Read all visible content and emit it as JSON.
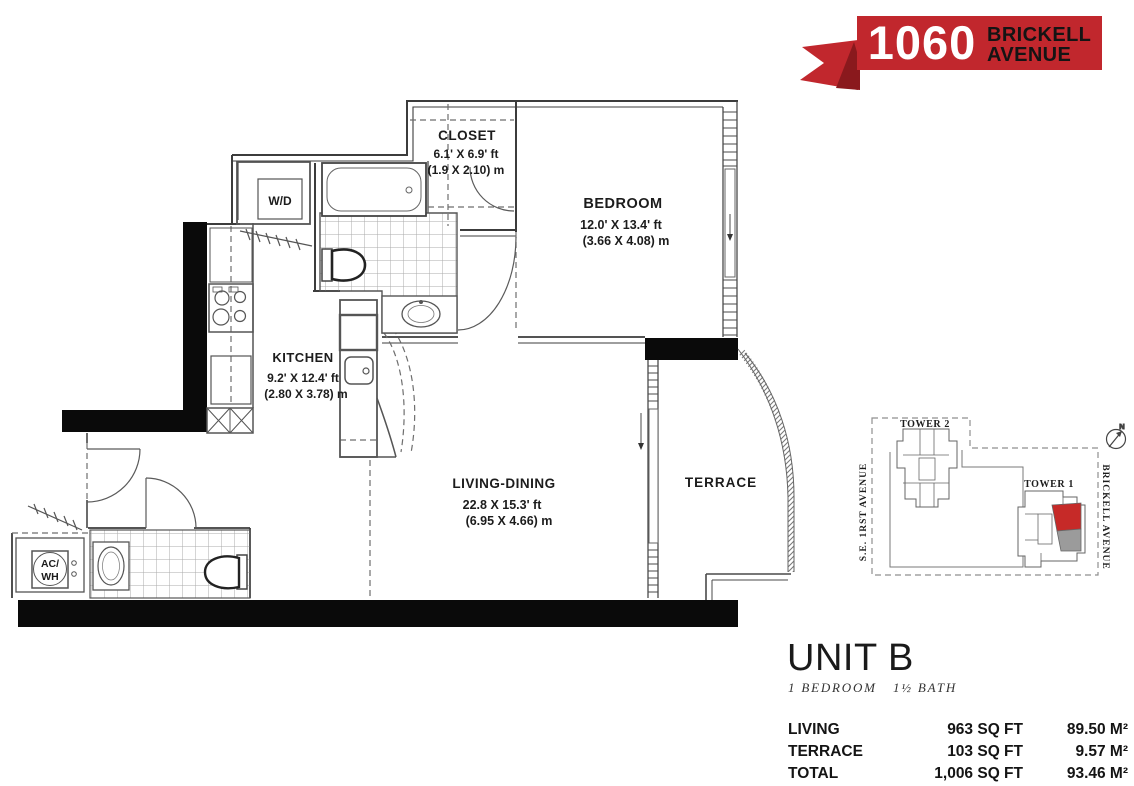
{
  "logo": {
    "number": "1060",
    "line1": "BRICKELL",
    "line2": "AVENUE",
    "red": "#c1272d",
    "dark_red": "#8a191d"
  },
  "rooms": {
    "closet": {
      "name": "CLOSET",
      "dim_ft": "6.1' X 6.9' ft",
      "dim_m": "(1.9 X 2.10) m"
    },
    "bedroom": {
      "name": "BEDROOM",
      "dim_ft": "12.0' X 13.4' ft",
      "dim_m": "(3.66 X 4.08) m"
    },
    "kitchen": {
      "name": "KITCHEN",
      "dim_ft": "9.2' X 12.4' ft",
      "dim_m": "(2.80 X 3.78) m"
    },
    "living": {
      "name": "LIVING-DINING",
      "dim_ft": "22.8 X 15.3' ft",
      "dim_m": "(6.95 X 4.66) m"
    },
    "terrace": {
      "name": "TERRACE"
    },
    "washer_dryer": {
      "name": "W/D"
    },
    "ac_water_heater": {
      "line1": "AC/",
      "line2": "WH"
    }
  },
  "sitemap": {
    "tower1": "TOWER 1",
    "tower2": "TOWER 2",
    "street_left": "S.E. 1RST AVENUE",
    "street_right": "BRICKELL AVENUE",
    "compass": "N",
    "highlight_red": "#c62a28",
    "highlight_gray": "#9b9b9b"
  },
  "unit": {
    "title": "UNIT B",
    "subtitle_bed": "1  BEDROOM",
    "subtitle_bath": "1½  BATH",
    "stats": [
      {
        "label": "LIVING",
        "sqft": "963 SQ FT",
        "m2": "89.50 M²"
      },
      {
        "label": "TERRACE",
        "sqft": "103 SQ FT",
        "m2": "9.57 M²"
      },
      {
        "label": "TOTAL",
        "sqft": "1,006 SQ FT",
        "m2": "93.46 M²"
      }
    ]
  }
}
